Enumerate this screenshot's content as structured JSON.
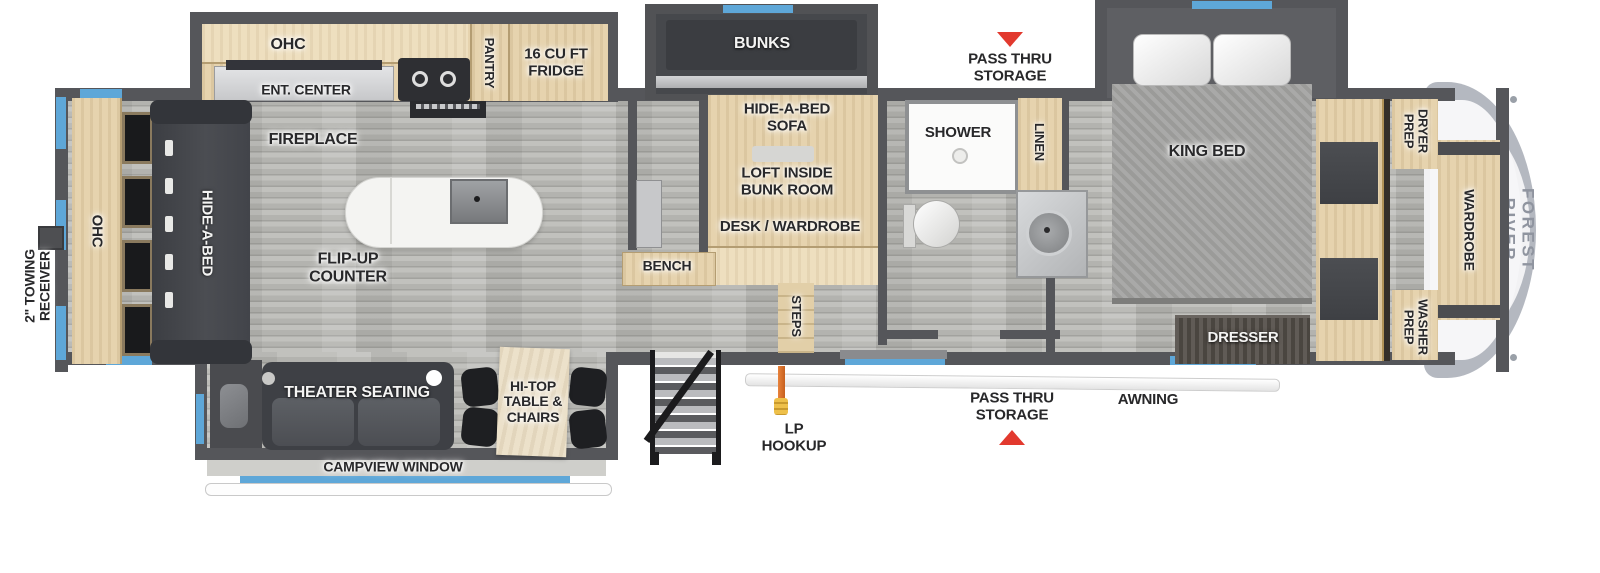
{
  "title": "Fifth Wheel RV Floorplan",
  "brand": "FOREST RIVER",
  "colors": {
    "wall_gray": "#55565a",
    "window_blue": "#5ea7d8",
    "alert_red": "#e2392e",
    "wood_tan": "#e6d3ae",
    "floor_gray": "#b3b3af",
    "sofa_charcoal": "#45474c",
    "brand_text_gray": "#8f949f"
  },
  "labels": {
    "kitchen_ohc": "OHC",
    "ent_center": "ENT. CENTER",
    "pantry": "PANTRY",
    "fridge": "16 CU FT\nFRIDGE",
    "bunks": "BUNKS",
    "pass_thru_top": "PASS THRU\nSTORAGE",
    "king_bed": "KING BED",
    "dryer_prep": "DRYER\nPREP",
    "wardrobe": "WARDROBE",
    "washer_prep": "WASHER\nPREP",
    "towing_receiver": "2\" TOWING\nRECEIVER",
    "rear_ohc": "OHC",
    "rear_hide_a_bed": "HIDE-A-BED",
    "fireplace": "FIREPLACE",
    "flip_up_counter": "FLIP-UP\nCOUNTER",
    "bunk_hide_a_bed_sofa": "HIDE-A-BED\nSOFA",
    "loft": "LOFT INSIDE\nBUNK ROOM",
    "desk_wardrobe": "DESK / WARDROBE",
    "bench": "BENCH",
    "steps": "STEPS",
    "shower": "SHOWER",
    "linen": "LINEN",
    "dresser": "DRESSER",
    "theater_seating": "THEATER SEATING",
    "hi_top": "HI-TOP\nTABLE &\nCHAIRS",
    "campview_window": "CAMPVIEW WINDOW",
    "lp_hookup": "LP\nHOOKUP",
    "pass_thru_bottom": "PASS THRU\nSTORAGE",
    "awning": "AWNING"
  }
}
